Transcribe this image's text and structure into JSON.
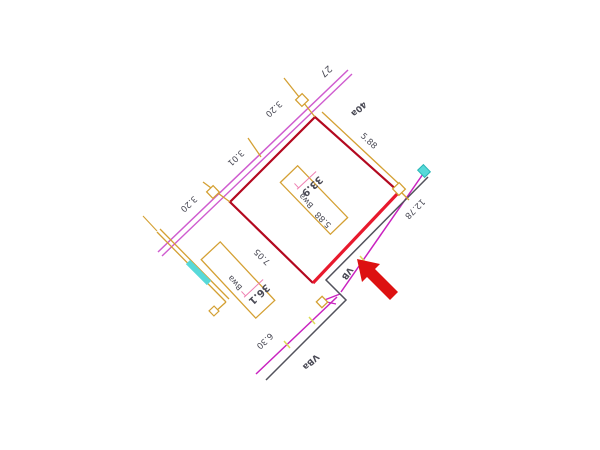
{
  "drawing": {
    "type": "cadastral-survey-plan",
    "labels": {
      "plot_27": "27",
      "dim_320_top": "3.20",
      "dim_301": "3.01",
      "dim_320_left": "3.20",
      "parcel_40a": "40a",
      "dim_588_ne": "5.88",
      "parcel_339": "33.9",
      "building_1": "Bwa",
      "dim_588_inner": "5.88",
      "dim_1278": "12.78",
      "dim_705": "7.05",
      "parcel_361": "36.1",
      "building_2": "Bwa",
      "road_vb": "VB",
      "dim_630": "6.30",
      "road_vba": "VBa"
    },
    "colors": {
      "road_upper": "#cf5ccf",
      "road_lower": "#c922c0",
      "boundary": "#b3081f",
      "boundary_edge": "#e8192d",
      "structure": "#d4a033",
      "cyan": "#57d9d9",
      "cyan_stroke": "#2ab6b6",
      "edge_dark": "#52525c",
      "dim_text": "#4a4a55",
      "parcel_pink": "#ee7fb2",
      "road_pink": "#cc44aa",
      "green_label": "#a0b030",
      "blue_label": "#5566cc",
      "tick_yellow": "#dcdc55",
      "arrow_red": "#dd1111",
      "node_fill": "#ffffff"
    }
  }
}
